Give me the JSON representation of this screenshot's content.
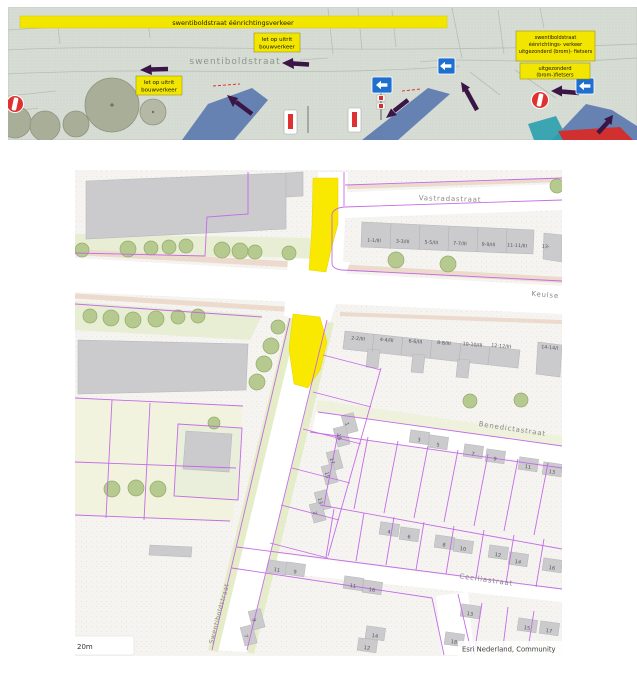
{
  "banner": {
    "one_way_bar": "swentiboldstraat éénrichtingsverkeer",
    "street_name": "swentiboldstraat",
    "warning_label": {
      "line1": "let op uitrit",
      "line2": "bouwverkeer"
    },
    "info_box_top": {
      "line1": "swentiboldstraat",
      "line2": "éénrichtings- verkeer",
      "line3": "uitgezonderd (brom)- fietsers"
    },
    "info_box_bottom": {
      "line1": "uitgezonderd",
      "line2": "(brom-)fietsers"
    }
  },
  "map": {
    "street_labels": {
      "vastradastraat": "Vastradastraat",
      "keulsebaan": "Keulse",
      "benedictastraat": "Benedictastraat",
      "ceciliastraat": "Ceciliastraat",
      "swentiboldstraat": "Swentiboldstraat"
    },
    "building_row_north": [
      "1-1/III",
      "3-3/III",
      "5-5/III",
      "7-7/III",
      "9-9/III",
      "11-11/III",
      "13-"
    ],
    "building_row_south": [
      "2-2/III",
      "4-4/III",
      "6-6/III",
      "8-8/III",
      "10-10/III",
      "12-12/III",
      "14-14/I"
    ],
    "house_numbers": [
      {
        "label": "1",
        "x": 347,
        "y": 424,
        "r": 75
      },
      {
        "label": "18",
        "x": 339,
        "y": 437,
        "r": 75
      },
      {
        "label": "17",
        "x": 332,
        "y": 461,
        "r": 75
      },
      {
        "label": "15",
        "x": 327,
        "y": 475,
        "r": 75
      },
      {
        "label": "13",
        "x": 320,
        "y": 501,
        "r": 75
      },
      {
        "label": "2",
        "x": 315,
        "y": 513,
        "r": 75
      },
      {
        "label": "3",
        "x": 419,
        "y": 440,
        "r": 8
      },
      {
        "label": "5",
        "x": 438,
        "y": 445,
        "r": 8
      },
      {
        "label": "7",
        "x": 473,
        "y": 454,
        "r": 8
      },
      {
        "label": "9",
        "x": 495,
        "y": 459,
        "r": 8
      },
      {
        "label": "11",
        "x": 528,
        "y": 467,
        "r": 8
      },
      {
        "label": "13",
        "x": 552,
        "y": 472,
        "r": 8
      },
      {
        "label": "4",
        "x": 389,
        "y": 532,
        "r": 8
      },
      {
        "label": "6",
        "x": 409,
        "y": 537,
        "r": 8
      },
      {
        "label": "8",
        "x": 444,
        "y": 545,
        "r": 8
      },
      {
        "label": "10",
        "x": 463,
        "y": 549,
        "r": 8
      },
      {
        "label": "12",
        "x": 498,
        "y": 555,
        "r": 8
      },
      {
        "label": "14",
        "x": 518,
        "y": 562,
        "r": 8
      },
      {
        "label": "16",
        "x": 552,
        "y": 568,
        "r": 8
      },
      {
        "label": "11",
        "x": 277,
        "y": 570,
        "r": 8
      },
      {
        "label": "9",
        "x": 295,
        "y": 572,
        "r": 8
      },
      {
        "label": "11",
        "x": 353,
        "y": 586,
        "r": 8
      },
      {
        "label": "16",
        "x": 372,
        "y": 590,
        "r": 8
      },
      {
        "label": "9",
        "x": 254,
        "y": 620,
        "r": 75
      },
      {
        "label": "7",
        "x": 246,
        "y": 636,
        "r": 75
      },
      {
        "label": "14",
        "x": 375,
        "y": 636,
        "r": 8
      },
      {
        "label": "12",
        "x": 367,
        "y": 648,
        "r": 8
      },
      {
        "label": "13",
        "x": 470,
        "y": 614,
        "r": 8
      },
      {
        "label": "15",
        "x": 527,
        "y": 628,
        "r": 8
      },
      {
        "label": "17",
        "x": 549,
        "y": 631,
        "r": 8
      },
      {
        "label": "18",
        "x": 454,
        "y": 642,
        "r": 8
      }
    ],
    "scale_label": "20m",
    "attribution": "Esri Nederland, Community"
  },
  "colors": {
    "highlight_yellow": "#f9e800",
    "plan_label_yellow": "#f2e500",
    "arrow_purple": "#3a1545",
    "sign_blue": "#1e6fd0",
    "no_entry_red": "#e03131",
    "cadastral_purple": "#c365e6",
    "road_blue": "#5b7ab0",
    "banner_background": "#d7ddd5",
    "tree_green": "#b6c98e"
  }
}
